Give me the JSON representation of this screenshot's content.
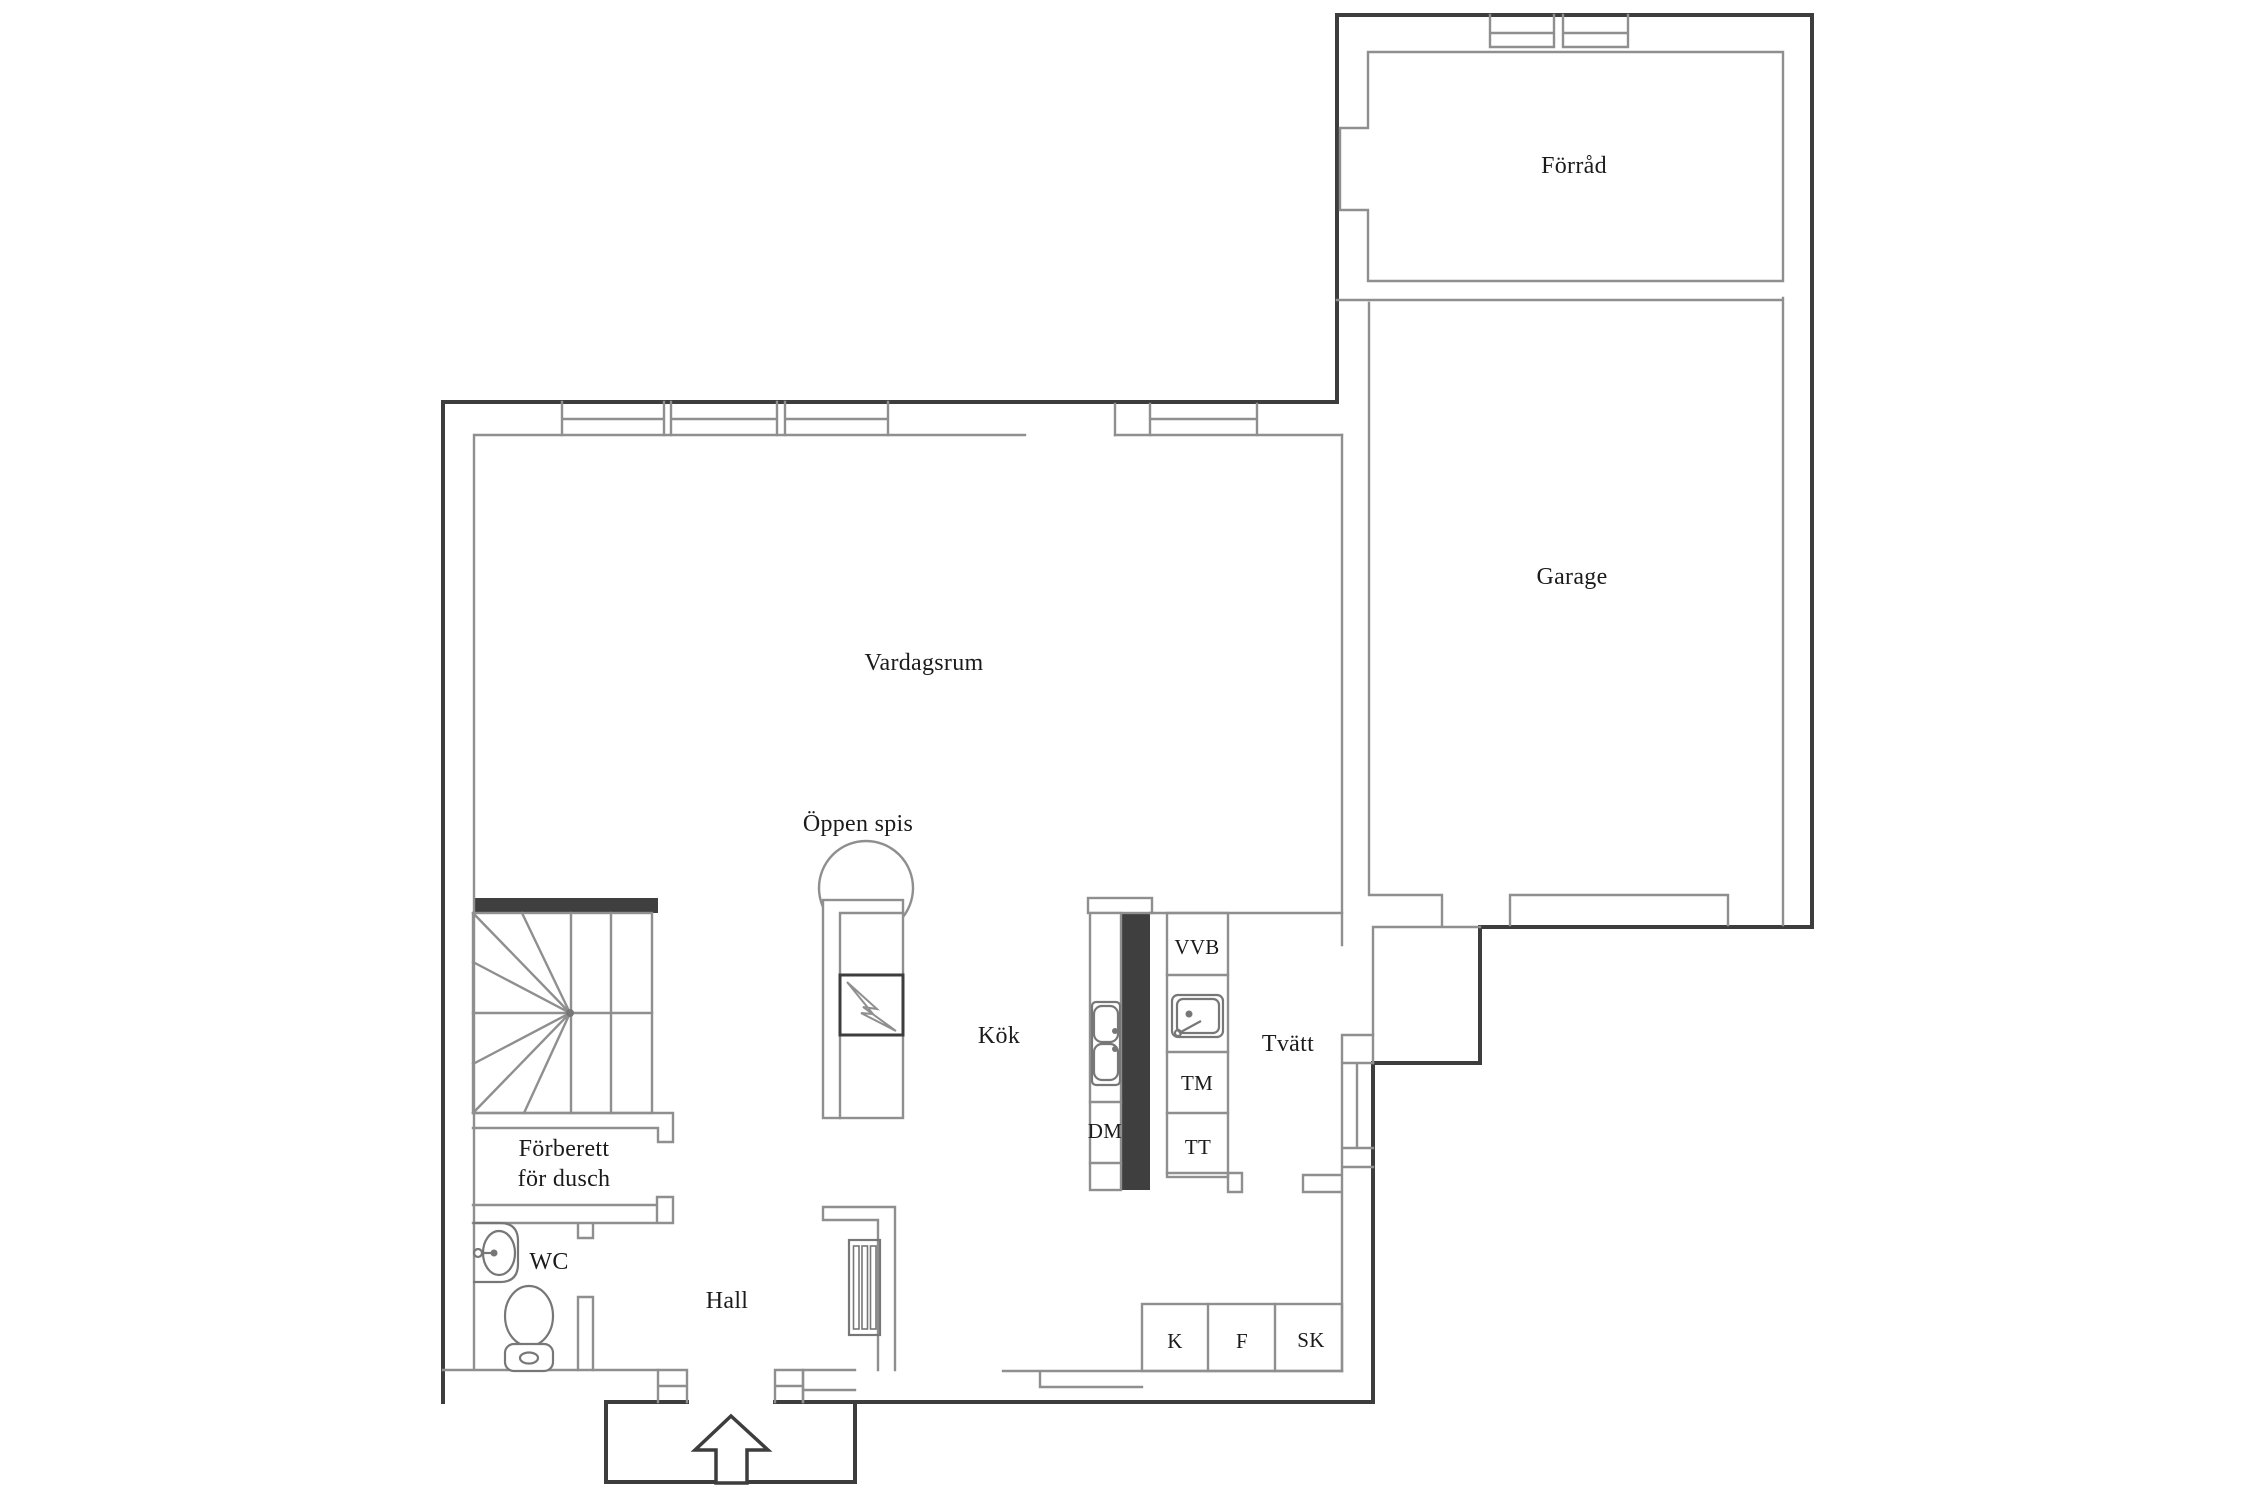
{
  "colors": {
    "background": "#ffffff",
    "wall_dark": "#3d3d3d",
    "wall_light": "#8f8f8f",
    "fixture": "#777777",
    "solid_wall_fill": "#3f3f3f",
    "text": "#1b1b1b"
  },
  "rooms": {
    "forrad": "Förråd",
    "garage": "Garage",
    "vardagsrum": "Vardagsrum",
    "oppen_spis": "Öppen spis",
    "kok": "Kök",
    "tvatt": "Tvätt",
    "hall": "Hall",
    "wc": "WC",
    "forberett_for_dusch": "Förberett\nför dusch"
  },
  "appliances": {
    "vvb": "VVB",
    "tm": "TM",
    "tt": "TT",
    "dm": "DM",
    "k": "K",
    "f": "F",
    "sk": "SK"
  },
  "icons": {
    "staircase-icon": "winder staircase with radiating treads",
    "fireplace-icon": "dome front, hearth square with lightning-bolt flue mark",
    "double-sink-icon": "two rounded kitchen basins with tap dots",
    "laundry-sink-icon": "square basin with tap",
    "wc-sink-icon": "oval hand basin with tap",
    "toilet-icon": "toilet bowl with cistern base",
    "radiator-icon": "slatted radiator rectangle",
    "entrance-arrow-icon": "upward entry arrow",
    "window-icon": "double parallel lines within wall band"
  }
}
